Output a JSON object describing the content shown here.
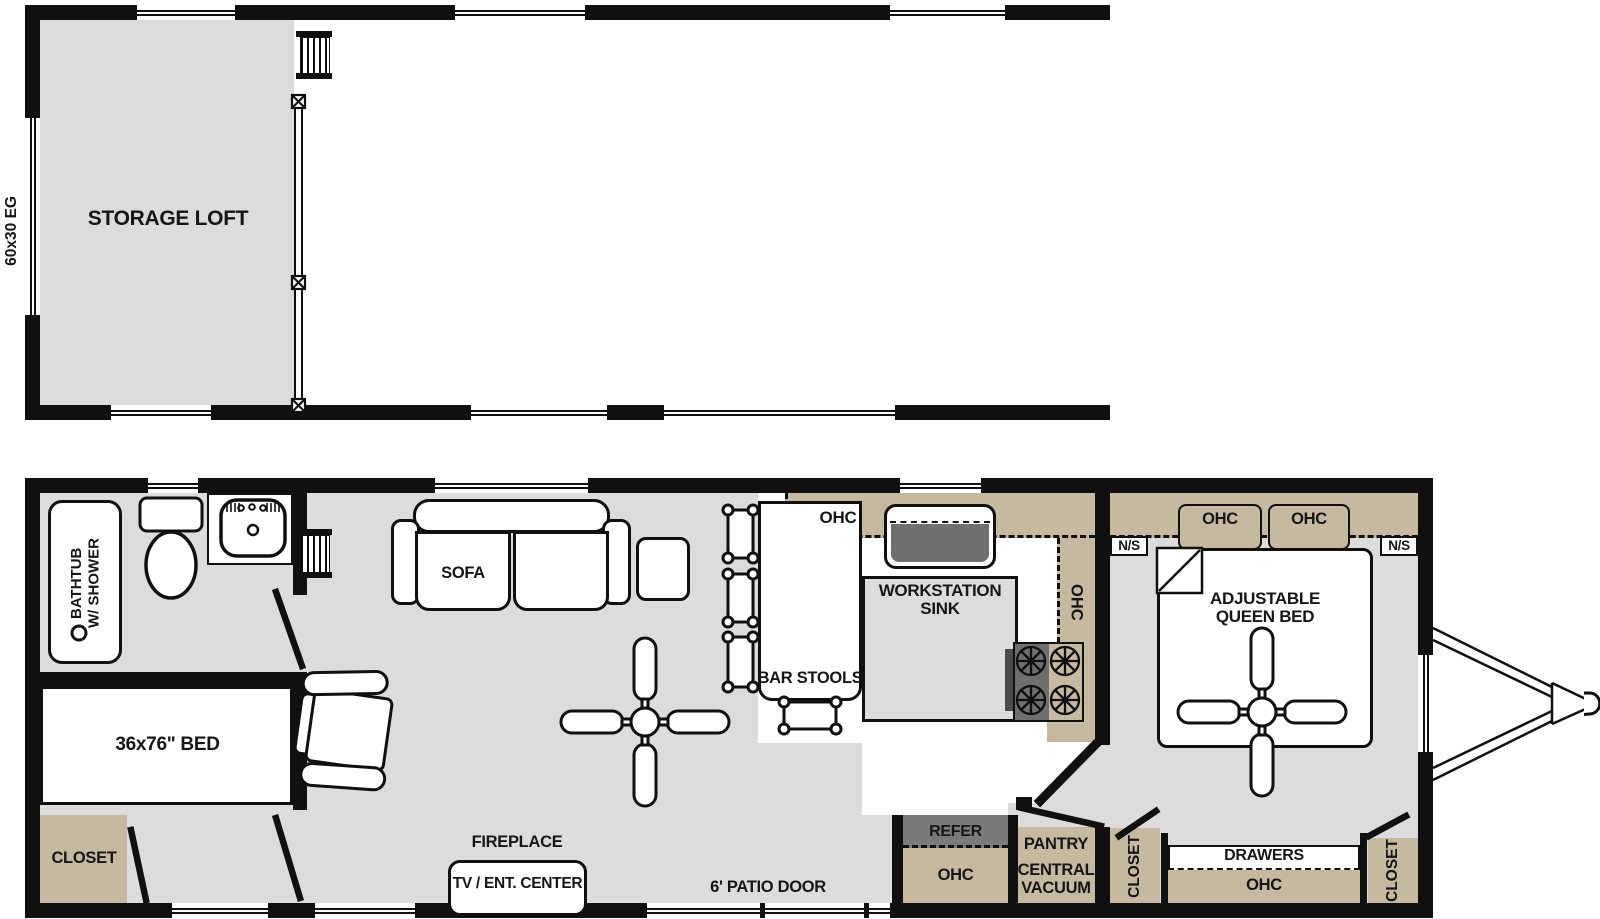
{
  "colors": {
    "wall": "#101010",
    "floor_gray": "#dcdcdc",
    "cabinet_tan": "#c5b9a0",
    "appliance_gray": "#737373",
    "white": "#ffffff"
  },
  "loft_plan": {
    "size_label": "60x30 EG",
    "storage_loft_label": "STORAGE LOFT"
  },
  "main_plan": {
    "bathroom": {
      "tub_label_lines": [
        "BATHTUB",
        "W/ SHOWER"
      ]
    },
    "front_bedroom": {
      "bed_label": "36x76\" BED",
      "closet_label": "CLOSET"
    },
    "living_room": {
      "sofa_label": "SOFA",
      "fireplace_label": "FIREPLACE",
      "tv_label": "TV / ENT. CENTER"
    },
    "kitchen": {
      "ohc_top_label": "OHC",
      "ohc_side_label": "OHC",
      "bar_stools_label": "BAR STOOLS",
      "sink_label_lines": [
        "WORKSTATION",
        "SINK"
      ]
    },
    "utility": {
      "refer_label": "REFER",
      "ohc_label": "OHC",
      "pantry_label": "PANTRY",
      "central_vacuum_lines": [
        "CENTRAL",
        "VACUUM"
      ]
    },
    "hallway": {
      "closet_label": "CLOSET"
    },
    "patio_door_label": "6' PATIO DOOR",
    "master_bedroom": {
      "ns_left_label": "N/S",
      "ns_right_label": "N/S",
      "ohc_left_label": "OHC",
      "ohc_right_label": "OHC",
      "bed_label_lines": [
        "ADJUSTABLE",
        "QUEEN BED"
      ],
      "drawers_label": "DRAWERS",
      "ohc_bottom_label": "OHC",
      "closet_label": "CLOSET"
    }
  }
}
